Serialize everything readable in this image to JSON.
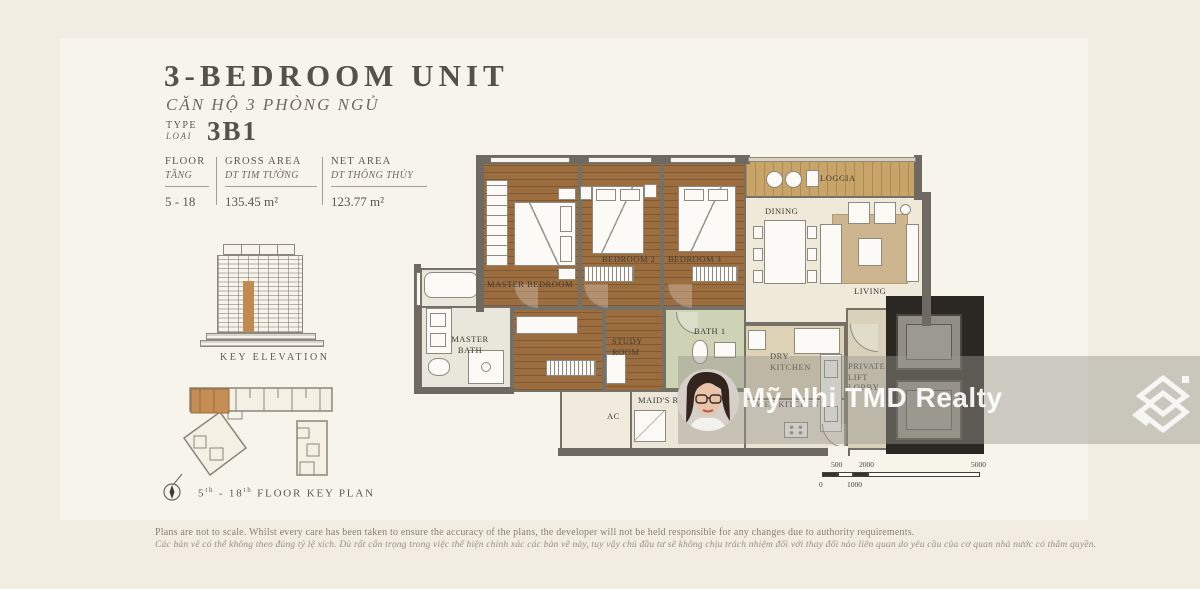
{
  "header": {
    "title": "3-BEDROOM UNIT",
    "subtitle": "CĂN HỘ 3 PHÒNG NGỦ",
    "type_label_top": "TYPE",
    "type_label_bottom": "LOẠI",
    "type_value": "3B1"
  },
  "spec_table": {
    "columns": [
      {
        "label_en": "FLOOR",
        "label_vi": "TẦNG",
        "value": "5 - 18"
      },
      {
        "label_en": "GROSS AREA",
        "label_vi": "DT TIM TƯỜNG",
        "value": "135.45 m²"
      },
      {
        "label_en": "NET AREA",
        "label_vi": "DT THÔNG THỦY",
        "value": "123.77 m²"
      }
    ]
  },
  "key_elevation": {
    "caption": "KEY ELEVATION"
  },
  "key_plan": {
    "caption_parts": [
      "5",
      "th",
      " - 18",
      "th",
      " FLOOR KEY PLAN"
    ]
  },
  "floor_plan": {
    "rooms": [
      {
        "id": "master-bedroom",
        "label": "MASTER BEDROOM"
      },
      {
        "id": "bedroom-2",
        "label": "BEDROOM 2"
      },
      {
        "id": "bedroom-3",
        "label": "BEDROOM 3"
      },
      {
        "id": "dining",
        "label": "DINING"
      },
      {
        "id": "loggia",
        "label": "LOGGIA"
      },
      {
        "id": "living",
        "label": "LIVING"
      },
      {
        "id": "master-bath",
        "label": "MASTER BATH"
      },
      {
        "id": "study-room",
        "label": "STUDY ROOM"
      },
      {
        "id": "bath-1",
        "label": "BATH 1"
      },
      {
        "id": "dry-kitchen",
        "label": "DRY KITCHEN"
      },
      {
        "id": "wet-kitchen",
        "label": "WET KITCHEN"
      },
      {
        "id": "private-lift-lobby",
        "label": "PRIVATE LIFT LOBBY"
      },
      {
        "id": "maids-room",
        "label": "MAID'S ROOM"
      },
      {
        "id": "ac",
        "label": "AC"
      }
    ]
  },
  "scale_bar": {
    "labels_top": [
      "500",
      "2000",
      "5000"
    ],
    "labels_bottom": [
      "0",
      "1000"
    ]
  },
  "watermark": {
    "text": "Mỹ Nhi TMD Realty"
  },
  "disclaimer": {
    "line_en": "Plans are not to scale. Whilst every care has been taken to ensure the accuracy of the plans, the developer will not be held responsible for any changes due to authority requirements.",
    "line_vi": "Các bản vẽ có thể không theo đúng tỷ lệ xích. Dù rất cẩn trọng trong việc thể hiện chính xác các bản vẽ này, tuy vậy chủ đầu tư sẽ không chịu trách nhiệm đối với thay đổi nào liên quan do yêu cầu của cơ quan nhà nước có thẩm quyền."
  },
  "colors": {
    "accent_orange": "#c08a52",
    "wood_floor": "#9c6d3f",
    "wall_gray": "#716c63",
    "loggia_wood": "#c8a469",
    "background": "#f1ede2"
  }
}
